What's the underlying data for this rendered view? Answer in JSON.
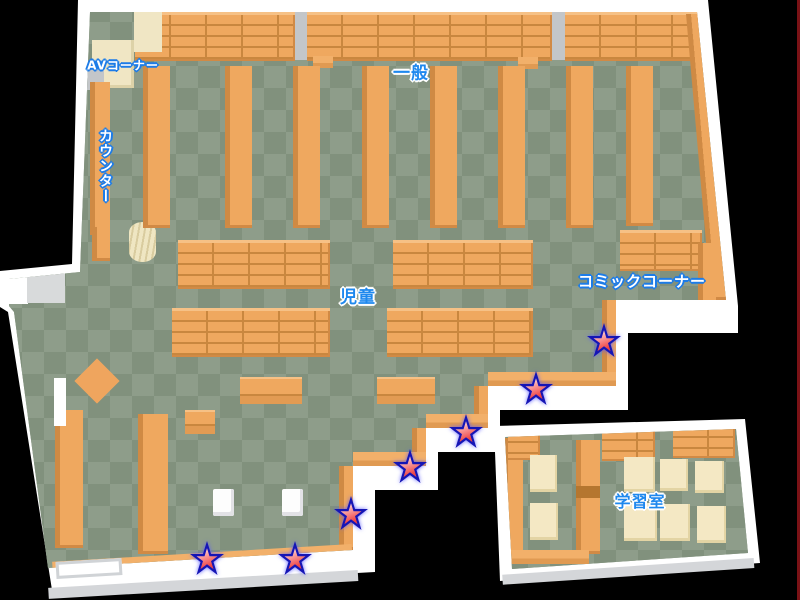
{
  "map": {
    "labels": {
      "av_corner": "AVコーナー",
      "counter": "カウンター",
      "general": "一般",
      "children": "児童",
      "comic_corner": "コミックコーナー",
      "study_room": "学習室"
    },
    "stars": [
      {
        "x": 604,
        "y": 340
      },
      {
        "x": 536,
        "y": 388
      },
      {
        "x": 466,
        "y": 431
      },
      {
        "x": 410,
        "y": 466
      },
      {
        "x": 351,
        "y": 513
      },
      {
        "x": 295,
        "y": 558
      },
      {
        "x": 207,
        "y": 558
      }
    ],
    "colors": {
      "background": "#000000",
      "wall": "#ffffff",
      "floor_light": "#8e9d8a",
      "floor_dark": "#81917d",
      "shelf": "#efa85f",
      "shelf_shadow": "#c9873f",
      "desk_cream": "#f4e8c4",
      "label_blue": "#1e88ee",
      "star_red": "#ee4545",
      "star_outline": "#1515b5"
    }
  }
}
